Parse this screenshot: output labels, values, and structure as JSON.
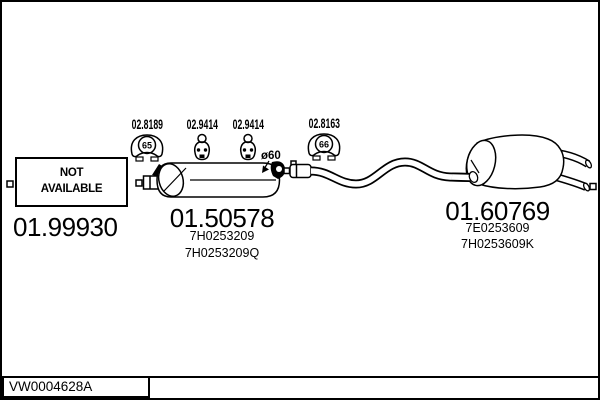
{
  "diagram": {
    "mounts": [
      {
        "code": "02.8189",
        "ring": "65"
      },
      {
        "code": "02.9414"
      },
      {
        "code": "02.9414"
      },
      {
        "code": "02.8163",
        "ring": "66"
      }
    ],
    "front_section": {
      "availability_line1": "NOT",
      "availability_line2": "AVAILABLE",
      "code": "01.99930"
    },
    "middle_muffler": {
      "code": "01.50578",
      "pipe_diameter": "ø60",
      "oem": [
        "7H0253209",
        "7H0253209Q"
      ]
    },
    "rear_muffler": {
      "code": "01.60769",
      "oem": [
        "7E0253609",
        "7H0253609K"
      ]
    },
    "footer": {
      "reference": "VW0004628A"
    }
  }
}
